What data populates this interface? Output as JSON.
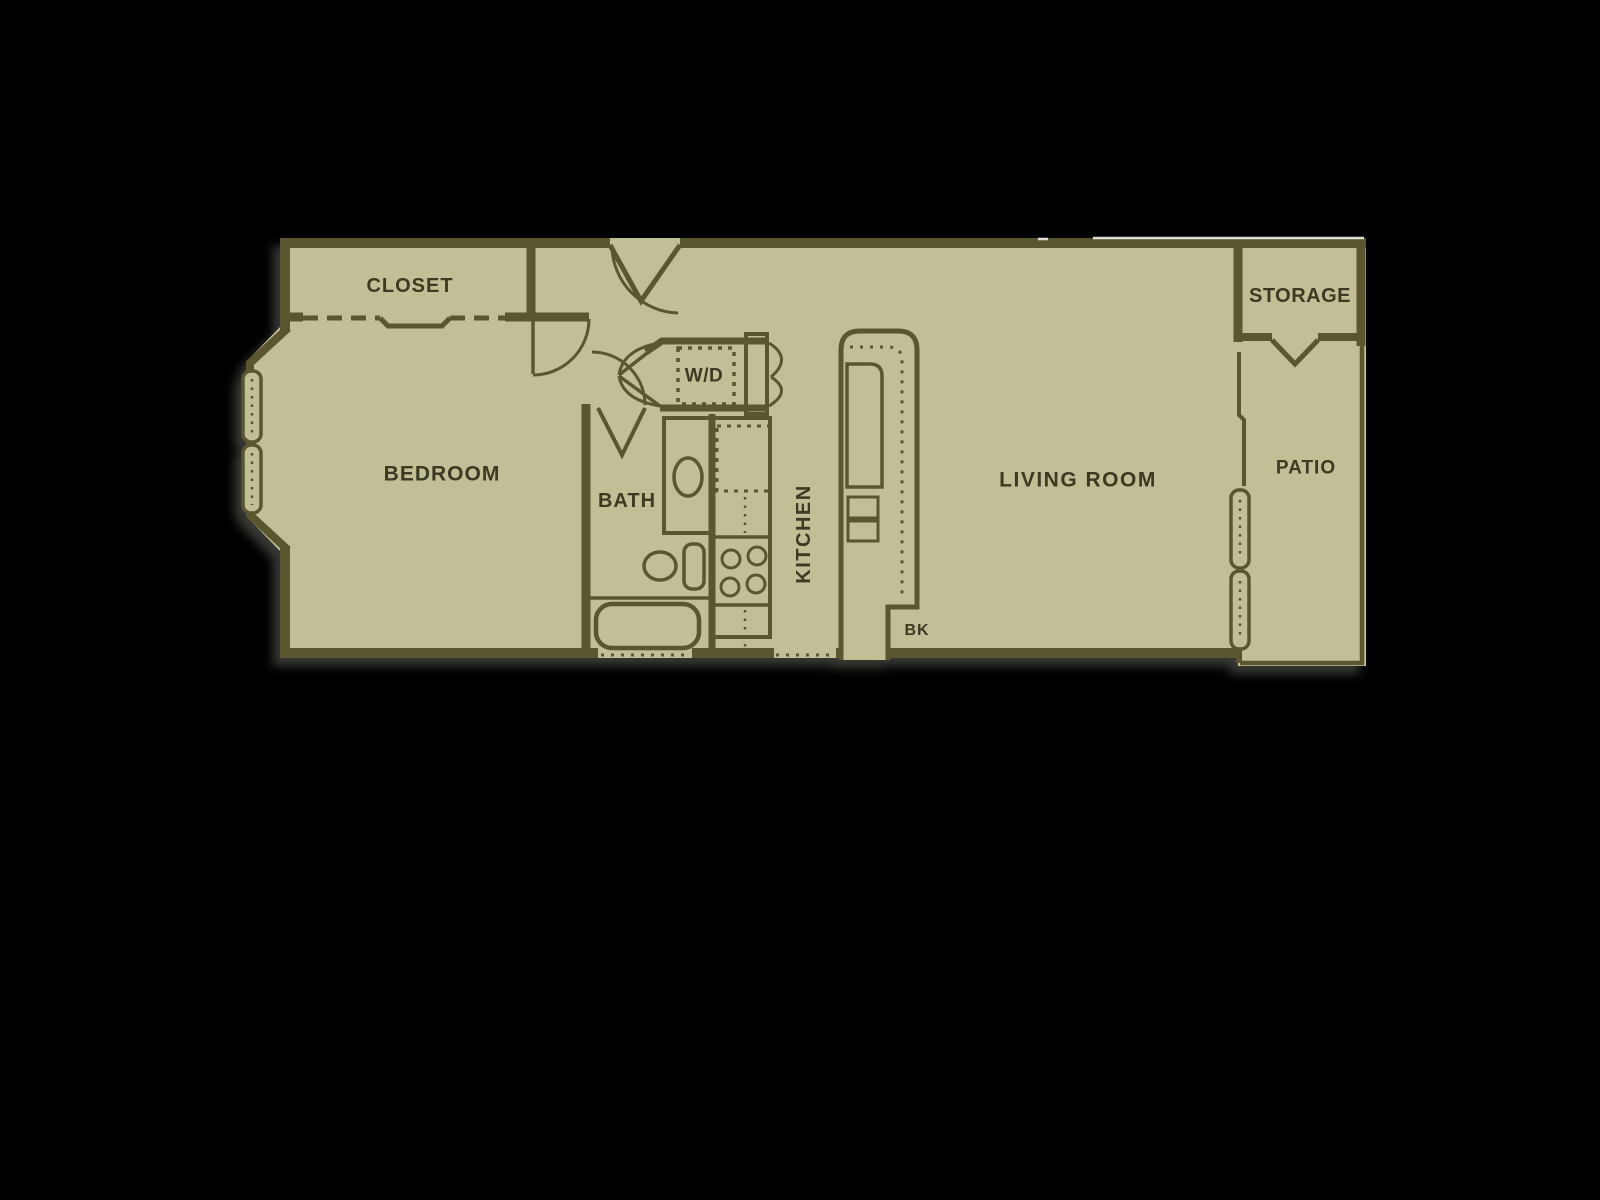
{
  "floorplan": {
    "colors": {
      "background": "#000000",
      "floor": "#c1bf95",
      "walls": "#5a572f",
      "labels": "#3c3a22"
    },
    "labels": {
      "closet": "CLOSET",
      "bedroom": "BEDROOM",
      "bath": "BATH",
      "washer_dryer": "W/D",
      "kitchen": "KITCHEN",
      "living_room": "LIVING ROOM",
      "breakfast_bar": "BK",
      "storage": "STORAGE",
      "patio": "PATIO"
    }
  }
}
